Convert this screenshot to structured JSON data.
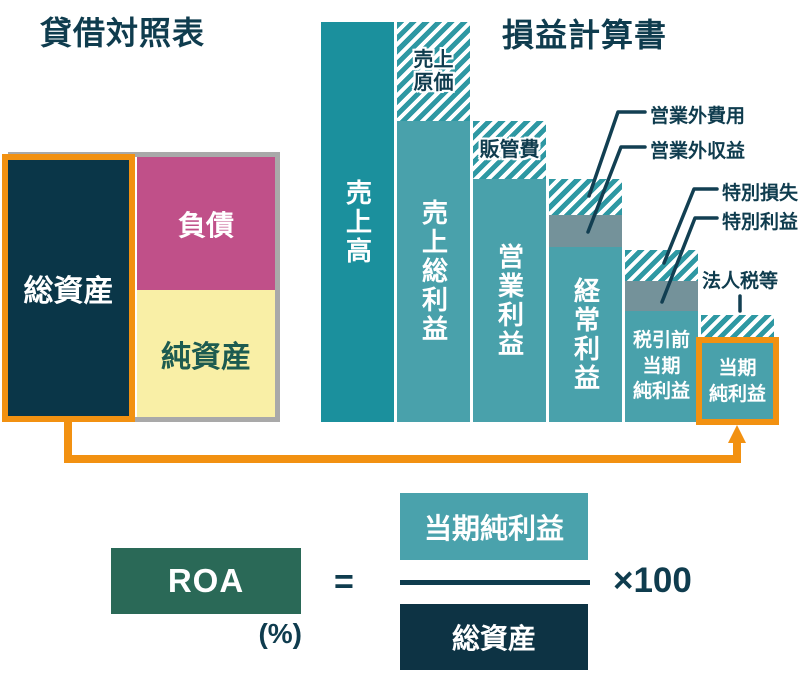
{
  "titles": {
    "balance_sheet": "貸借対照表",
    "income_statement": "損益計算書"
  },
  "balance_sheet": {
    "total_assets": "総資産",
    "liabilities": "負債",
    "net_assets": "純資産"
  },
  "formula": {
    "name": "ROA",
    "unit": "(%)",
    "equals": "=",
    "numerator": "当期純利益",
    "denominator": "総資産",
    "multiplier": "×100"
  },
  "colors": {
    "accent_orange": "#f29111",
    "bar_sales_teal": "#1b909d",
    "bar_teal": "#49a1ab",
    "hatch_teal": "#2e98a3",
    "gray_segment": "#74929a",
    "navy": "#0a3648",
    "text_navy": "#0f3c4e",
    "liabilities_pink": "#c05089",
    "net_assets_yellow": "#f9efa6",
    "roa_green": "#2a6957",
    "frame_gray": "#a9a9a9"
  },
  "chart_data": {
    "type": "bar",
    "subtype": "waterfall-decomposition",
    "title": "損益計算書",
    "unit": "schematic height, % of 売上高",
    "baseline_y": 422,
    "left_x": 321,
    "bar_width": 73,
    "bar_gap": 3,
    "bars": [
      {
        "id": "sales",
        "label": "売上高",
        "label_mode": "vertical",
        "segments": [
          {
            "id": "sales",
            "kind": "solid-dark",
            "h": 400,
            "value_pct": 100
          }
        ]
      },
      {
        "id": "gross-profit",
        "label": "売上総利益",
        "label_mode": "vertical",
        "segments": [
          {
            "id": "cost-of-sales",
            "kind": "hatch",
            "h": 99,
            "value_pct": 25,
            "label": [
              "売上",
              "原価"
            ]
          },
          {
            "id": "gross-profit",
            "kind": "solid",
            "h": 301,
            "value_pct": 75
          }
        ]
      },
      {
        "id": "operating-profit",
        "label": "営業利益",
        "label_mode": "vertical",
        "segments": [
          {
            "id": "sga",
            "kind": "hatch",
            "h": 58,
            "value_pct": 14.5,
            "label": [
              "販管費"
            ]
          },
          {
            "id": "operating-profit",
            "kind": "solid",
            "h": 243,
            "value_pct": 61
          }
        ]
      },
      {
        "id": "ordinary-profit",
        "label": "経常利益",
        "label_mode": "vertical",
        "segments": [
          {
            "id": "non-operating-expenses",
            "kind": "hatch",
            "h": 36,
            "value_pct": 9
          },
          {
            "id": "non-operating-income",
            "kind": "gray",
            "h": 32,
            "value_pct": 8
          },
          {
            "id": "ordinary-profit",
            "kind": "solid",
            "h": 175,
            "value_pct": 44
          }
        ]
      },
      {
        "id": "pretax-net-income",
        "label": [
          "税引前",
          "当期",
          "純利益"
        ],
        "label_mode": "lines",
        "segments": [
          {
            "id": "extraordinary-loss",
            "kind": "hatch",
            "h": 31,
            "value_pct": 8
          },
          {
            "id": "extraordinary-gain",
            "kind": "gray",
            "h": 30,
            "value_pct": 7.5
          },
          {
            "id": "pretax-net-income",
            "kind": "solid",
            "h": 111,
            "value_pct": 28
          }
        ]
      },
      {
        "id": "net-income",
        "label": [
          "当期",
          "純利益"
        ],
        "label_mode": "lines",
        "segments": [
          {
            "id": "corporate-tax",
            "kind": "hatch",
            "h": 27,
            "value_pct": 7
          },
          {
            "id": "net-income",
            "kind": "solid",
            "h": 80,
            "value_pct": 20
          }
        ]
      }
    ],
    "annotations": [
      {
        "id": "non-operating-expenses",
        "label": "営業外費用",
        "x": 650,
        "y": 101,
        "line": [
          [
            645,
            112
          ],
          [
            618,
            112
          ],
          [
            589,
            196
          ]
        ]
      },
      {
        "id": "non-operating-income",
        "label": "営業外収益",
        "x": 650,
        "y": 136,
        "line": [
          [
            645,
            147
          ],
          [
            621,
            147
          ],
          [
            588,
            232
          ]
        ]
      },
      {
        "id": "extraordinary-loss",
        "label": "特別損失",
        "x": 722,
        "y": 178,
        "line": [
          [
            717,
            189
          ],
          [
            694,
            189
          ],
          [
            664,
            263
          ]
        ]
      },
      {
        "id": "extraordinary-gain",
        "label": "特別利益",
        "x": 722,
        "y": 207,
        "line": [
          [
            717,
            218
          ],
          [
            695,
            218
          ],
          [
            662,
            302
          ]
        ]
      },
      {
        "id": "corporate-tax",
        "label": "法人税等",
        "x": 702,
        "y": 266,
        "line": [
          [
            740,
            296
          ],
          [
            740,
            311
          ]
        ]
      }
    ]
  }
}
